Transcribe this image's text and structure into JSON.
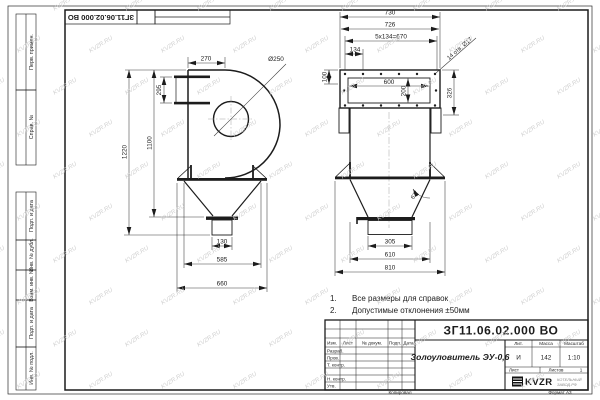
{
  "page": {
    "watermark": "KVZR.RU"
  },
  "stamp_top": {
    "doc_number": "ЗГ11.06.02.000 ВО"
  },
  "sidebar": {
    "items": [
      "Перв. примен.",
      "Справ. №",
      "Подп. и дата",
      "Инв. № дубл.",
      "Взам. инв. №",
      "Подп. и дата",
      "Инв. № подл."
    ]
  },
  "notes": {
    "n1_num": "1.",
    "n1_text": "Все размеры для справок",
    "n2_num": "2.",
    "n2_text": "Допустимые отклонения ±50мм"
  },
  "front_view": {
    "dim_270": "270",
    "dim_d250": "Ø250",
    "dim_295": "295",
    "dim_1220": "1220",
    "dim_1100": "1100",
    "dim_130": "130",
    "dim_585": "585",
    "dim_660": "660"
  },
  "side_view": {
    "dim_730": "730",
    "dim_726": "726",
    "dim_pitch": "5x134=670",
    "dim_134": "134",
    "dim_100": "100",
    "dim_600": "600",
    "dim_200": "200",
    "dim_326": "326",
    "holes_note": "14 отв. Ø17",
    "angle": "67°",
    "dim_305": "305",
    "dim_610": "610",
    "dim_810": "810"
  },
  "title_block": {
    "doc_number": "ЗГ11.06.02.000 ВО",
    "name": "Золоуловитель ЭУ-0,6",
    "headers": {
      "izm": "Изм.",
      "list": "Лист",
      "doc": "№ докум.",
      "sign": "Подп.",
      "date": "Дата",
      "lit": "Лит.",
      "mass": "Масса",
      "scale": "Масштаб",
      "sheet": "Лист",
      "sheets": "Листов"
    },
    "rows": {
      "developed": "Разраб.",
      "checked": "Пров.",
      "tcontr": "Т. контр.",
      "ncontr": "Н. контр.",
      "approved": "Утв."
    },
    "values": {
      "lit": "И",
      "mass": "142",
      "scale": "1:10",
      "sheets_count": "1"
    },
    "logo": {
      "text": "KVZR",
      "sub1": "КОТЕЛЬНЫЙ",
      "sub2": "ЗАВОД.РФ"
    }
  },
  "footer": {
    "copied": "Копировал",
    "format": "Формат А3"
  }
}
